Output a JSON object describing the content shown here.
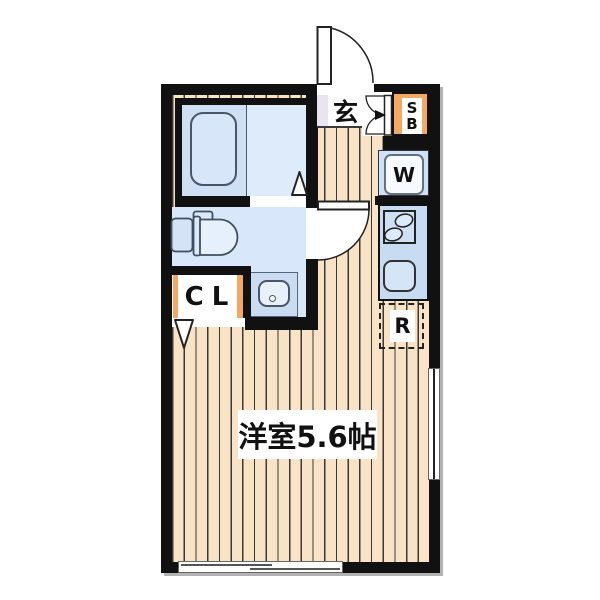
{
  "plan": {
    "main_room": {
      "label": "洋室5.6帖"
    },
    "entrance": {
      "label": "玄"
    },
    "shoe_box": {
      "line1": "S",
      "line2": "B"
    },
    "washer_space": {
      "label": "W"
    },
    "refrigerator_space": {
      "label": "R"
    },
    "closet": {
      "label": "CL"
    },
    "colors": {
      "wall": "#111111",
      "floor": "#f8e3c6",
      "floor_line": "#3b3833",
      "bath_blue": "#cfe0f5",
      "bath_blue_light": "#ddebfb",
      "washroom_blue": "#d9e7fa",
      "fixture_blue": "#c7dbf3",
      "genkan_lavender": "#e8e5f0",
      "accent_orange": "#f3a964"
    }
  }
}
